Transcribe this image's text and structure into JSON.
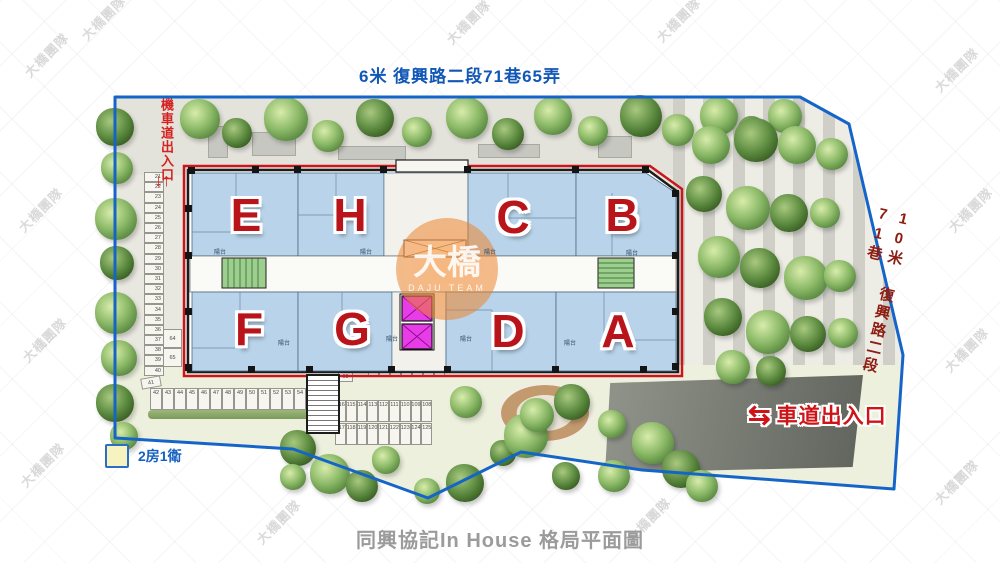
{
  "watermark": {
    "text": "大橋團隊",
    "logo": "大橋",
    "sub": "DAJU TEAM"
  },
  "roads": {
    "top": "6米 復興路二段71巷65弄",
    "right": "10米 復興路二段71巷",
    "moto_text": "機車道出入口",
    "moto_arrows": "↓↑",
    "car_text": "車道出入口",
    "car_arrows": "⇆"
  },
  "units": {
    "top": [
      "E",
      "H",
      "C",
      "B"
    ],
    "bottom": [
      "F",
      "G",
      "D",
      "A"
    ]
  },
  "balcony": {
    "label": "陽台"
  },
  "parking": {
    "left": [
      "21",
      "22",
      "23",
      "24",
      "25",
      "26",
      "27",
      "28",
      "29",
      "30",
      "31",
      "32",
      "33",
      "34",
      "35",
      "36",
      "37",
      "38",
      "39",
      "40"
    ],
    "s41": "41",
    "row": [
      "42",
      "43",
      "44",
      "45",
      "46",
      "47",
      "48",
      "49",
      "50",
      "51",
      "52",
      "53",
      "54"
    ],
    "pair": [
      "64",
      "65"
    ],
    "s98": "98",
    "upper": [
      "116",
      "115",
      "114",
      "113",
      "112",
      "111",
      "110",
      "109",
      "108"
    ],
    "lower": [
      "117",
      "118",
      "119",
      "120",
      "121",
      "122",
      "123",
      "124",
      "125"
    ]
  },
  "legend": {
    "label": "2房1衛",
    "swatch_color": "#f7f3c1",
    "swatch_border": "#2b6fc4"
  },
  "title": {
    "text": "同興協記In House 格局平面圖"
  },
  "colors": {
    "site_boundary": "#1565c8",
    "road_top_text": "#1157b5",
    "road_right_text": "#8e1c10",
    "entrance_red": "#d42222",
    "unit_letter_red": "#b8141a",
    "unit_fill": "#b9d4ea",
    "elevator_magenta": "#e93ce9",
    "stair_green": "#9ccf8d",
    "title_gray": "#9b9b9b"
  }
}
